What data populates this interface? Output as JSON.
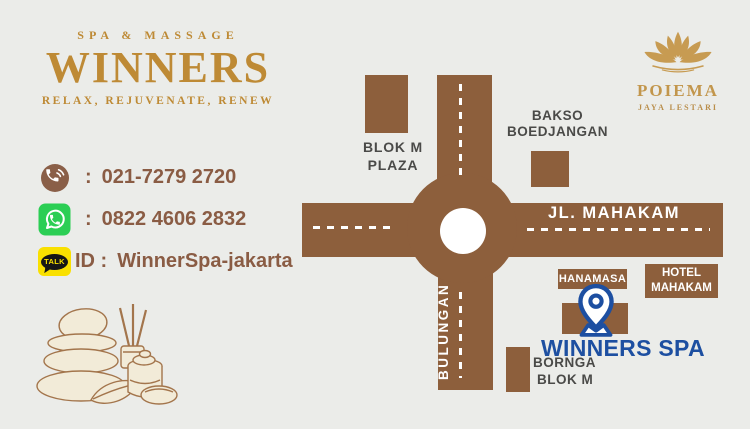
{
  "brand": {
    "top": "SPA & MASSAGE",
    "name": "WINNERS",
    "tagline": "RELAX, REJUVENATE, RENEW"
  },
  "contacts": {
    "phone": {
      "prefix": ":",
      "value": "021-7279 2720"
    },
    "whatsapp": {
      "prefix": ":",
      "value": "0822 4606 2832"
    },
    "kakao": {
      "prefix": "ID :",
      "value": "WinnerSpa-jakarta",
      "badge": "TALK"
    }
  },
  "poiema": {
    "name": "POIEMA",
    "subtitle": "JAYA LESTARI"
  },
  "map": {
    "street_horizontal": "JL. MAHAKAM",
    "street_vertical": "BULUNGAN",
    "blok_m_plaza": {
      "line1": "BLOK M",
      "line2": "PLAZA"
    },
    "bakso": {
      "line1": "BAKSO",
      "line2": "BOEDJANGAN"
    },
    "hanamasa": "HANAMASA",
    "hotel": {
      "line1": "HOTEL",
      "line2": "MAHAKAM"
    },
    "destination": "WINNERS SPA",
    "bornga": {
      "line1": "BORNGA",
      "line2": "BLOK M"
    }
  },
  "colors": {
    "background": "#EBECE9",
    "gold": "#BE8A35",
    "road_brown": "#8D5F3C",
    "contact_brown": "#8A5C44",
    "label_dark": "#4A4A48",
    "destination_blue": "#1D4FA1",
    "whatsapp_green": "#2BCE54",
    "kakao_yellow": "#F9E000"
  }
}
